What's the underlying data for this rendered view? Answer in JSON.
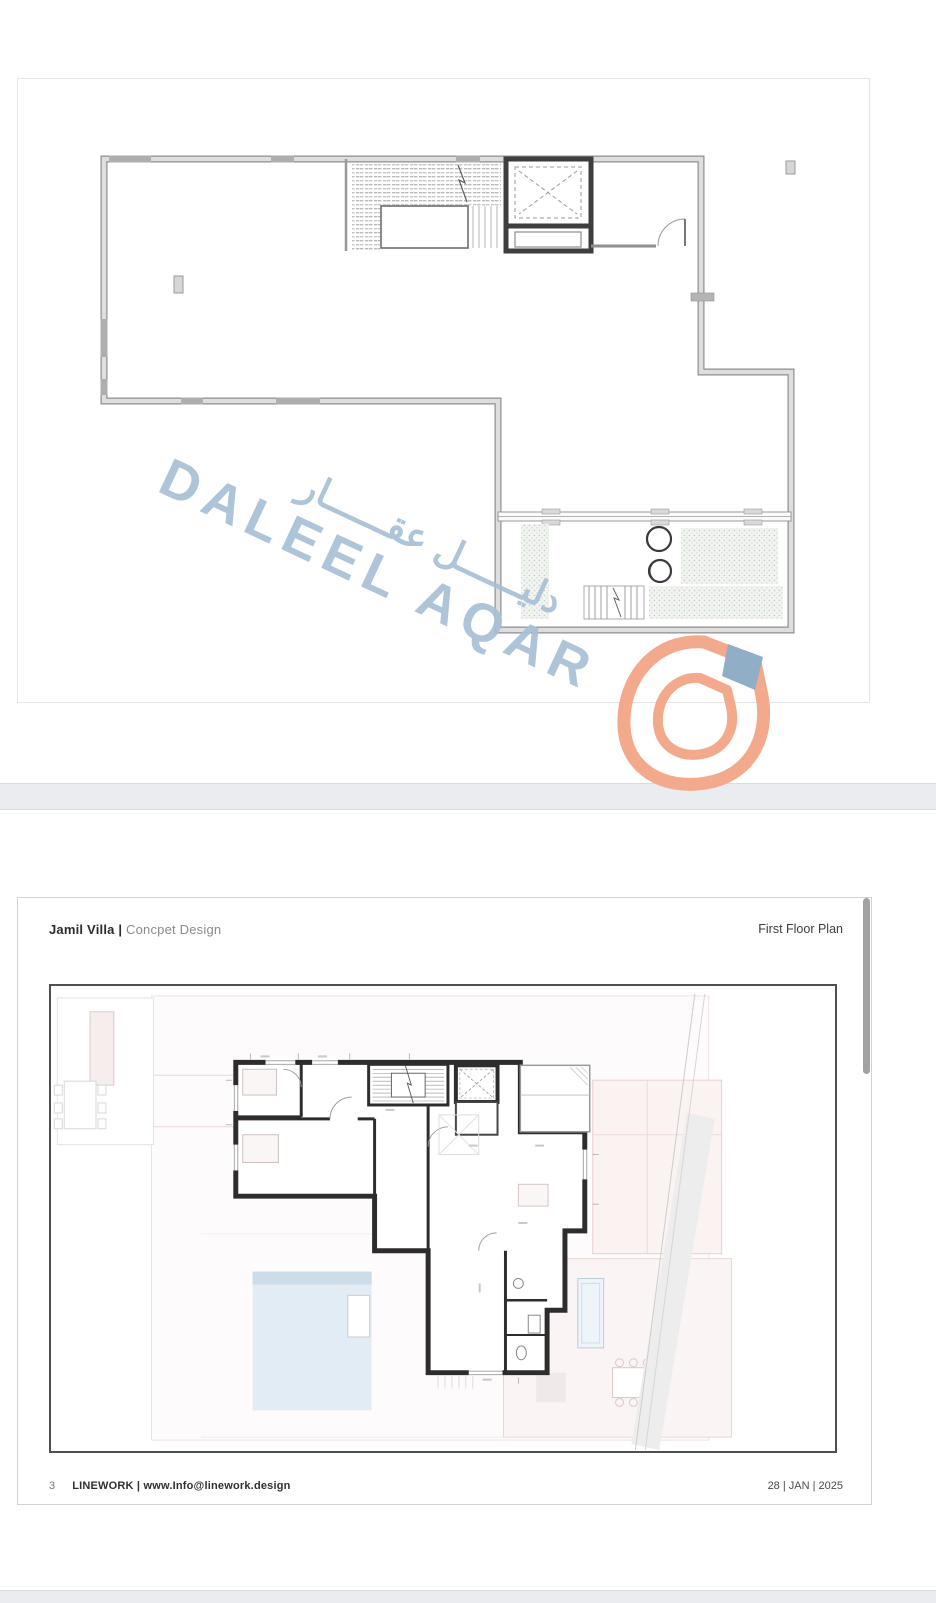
{
  "page1": {
    "watermark": {
      "arabic": "دليــــــل عقــــــار",
      "latin": "DALEEL AQAR",
      "color": "#a7c0d6"
    },
    "logo": {
      "primary_color": "#f3a98b",
      "accent_color": "#90aec6"
    }
  },
  "page2": {
    "header": {
      "project_bold": "Jamil Villa |",
      "project_light": "Concpet Design",
      "sheet_title": "First Floor Plan"
    },
    "footer": {
      "page_number": "3",
      "company_bold": "LINEWORK | www.Info@linework.design",
      "date": "28 | JAN | 2025"
    }
  }
}
